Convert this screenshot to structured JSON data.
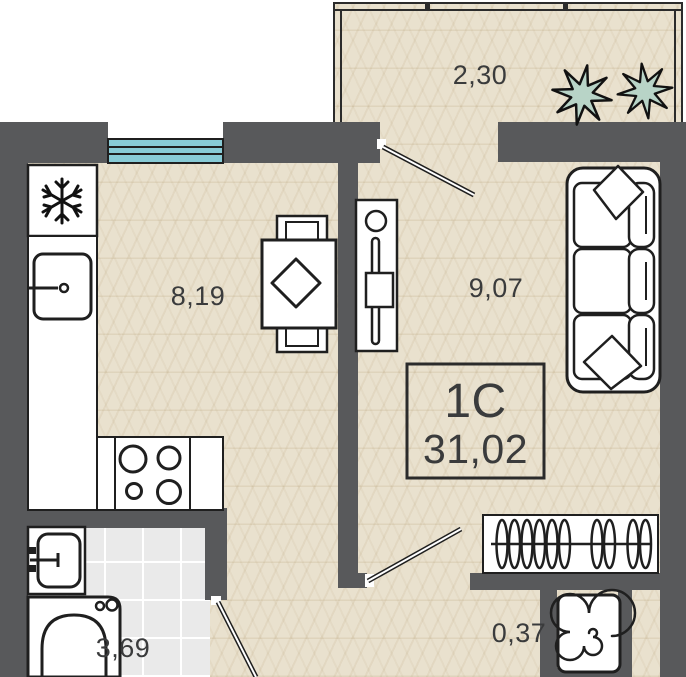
{
  "title_block": {
    "type": "1С",
    "area": "31,02"
  },
  "rooms": {
    "balcony": {
      "name": "balcony",
      "area": "2,30"
    },
    "kitchen": {
      "name": "kitchen",
      "area": "8,19"
    },
    "living": {
      "name": "living-room",
      "area": "9,07"
    },
    "bathroom": {
      "name": "bathroom",
      "area": "3,69"
    },
    "niche": {
      "name": "washer-niche",
      "area": "0,37"
    }
  },
  "colors": {
    "wall": "#58595b",
    "floor": "#e9e1ce",
    "tile": "#eaeaea",
    "window": "#88cbd6",
    "plant": "#b8d4c7",
    "outline": "#1f1f1f"
  },
  "icons": {
    "fridge": "snowflake-icon",
    "washer": "spiral-drum-icon",
    "stove": "four-burners-icon",
    "balcony_decor": "plant-icon"
  }
}
